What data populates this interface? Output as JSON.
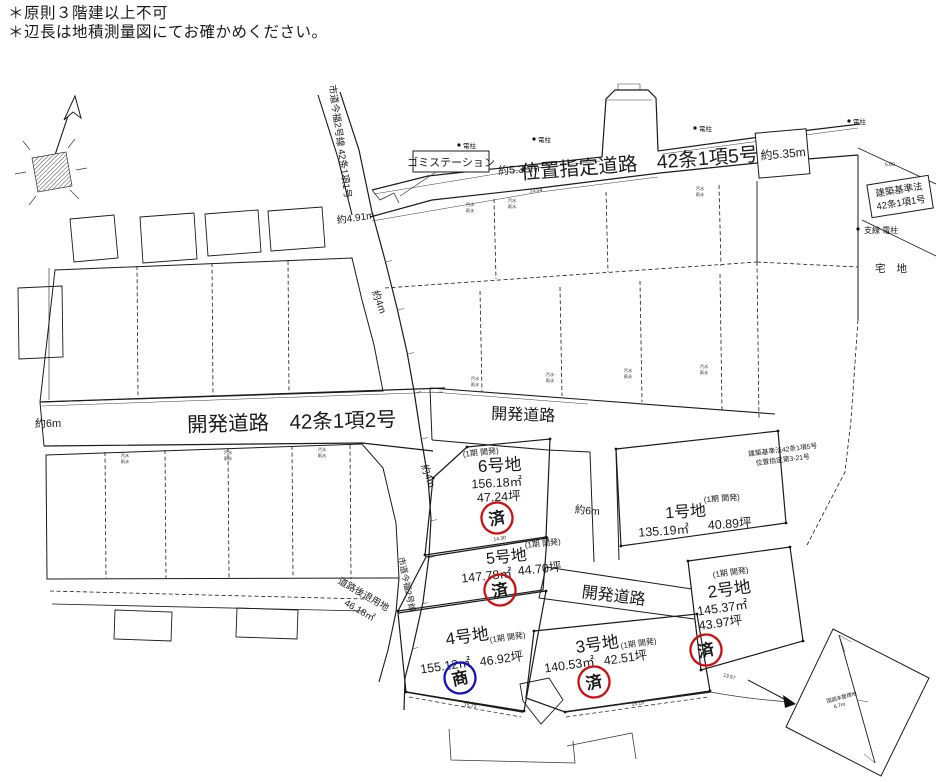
{
  "notes": {
    "line1": "＊原則３階建以上不可",
    "line2": "＊辺長は地積測量図にてお確かめください。"
  },
  "roads": {
    "shitei_douro": "位置指定道路　42条1項5号",
    "kaihatsu_douro_main": "開発道路　42条1項2号",
    "kaihatsu_douro": "開発道路",
    "shidou_vertical": "市道今福2号線 42条1項1号",
    "shidou": "市道今福2号線",
    "kijunhou_box_line1": "建築基準法",
    "kijunhou_box_line2": "42条1項1号",
    "kijunhou_small_line1": "建築基準法42条1項5号",
    "kijunhou_small_line2": "位置指定第3-21号"
  },
  "widths": {
    "w_535": "約5.35m",
    "w_6": "約6m",
    "w_4": "約4m",
    "w_491": "約4.91m"
  },
  "features": {
    "gomi_station": "ゴミステーション",
    "denchu": "電柱",
    "shisen_denchu": "支線 電柱",
    "takuchi": "宅 地",
    "setback_label": "道路後退用地",
    "setback_area": "46.18㎡",
    "inset_label": "国調未整理地",
    "inset_dim": "6.7m"
  },
  "lots": [
    {
      "name": "1号地",
      "phase": "(1期 開発)",
      "area_m2": "135.19㎡",
      "area_tsubo": "40.89坪",
      "stamp": null
    },
    {
      "name": "2号地",
      "phase": "(1期 開発)",
      "area_m2": "145.37㎡",
      "area_tsubo": "43.97坪",
      "stamp": "済"
    },
    {
      "name": "3号地",
      "phase": "(1期 開発)",
      "area_m2": "140.53㎡",
      "area_tsubo": "42.51坪",
      "stamp": "済"
    },
    {
      "name": "4号地",
      "phase": "(1期 開発)",
      "area_m2": "155.12㎡",
      "area_tsubo": "46.92坪",
      "stamp": "商"
    },
    {
      "name": "5号地",
      "phase": "(1期 開発)",
      "area_m2": "147.78㎡",
      "area_tsubo": "44.70坪",
      "stamp": "済"
    },
    {
      "name": "6号地",
      "phase": "(1期 開発)",
      "area_m2": "156.18㎡",
      "area_tsubo": "47.24坪",
      "stamp": "済"
    }
  ],
  "dims": {
    "d1": "13.54",
    "d2": "5.60",
    "d3": "14.30",
    "d4": "15.73",
    "d5": "15.19",
    "d6": "13.57"
  },
  "utility": {
    "osui": "汚水",
    "usui": "雨水"
  },
  "colors": {
    "sold_stamp": "#cc1010",
    "negotiation_stamp": "#1212bb",
    "line": "#1b1b1b"
  }
}
